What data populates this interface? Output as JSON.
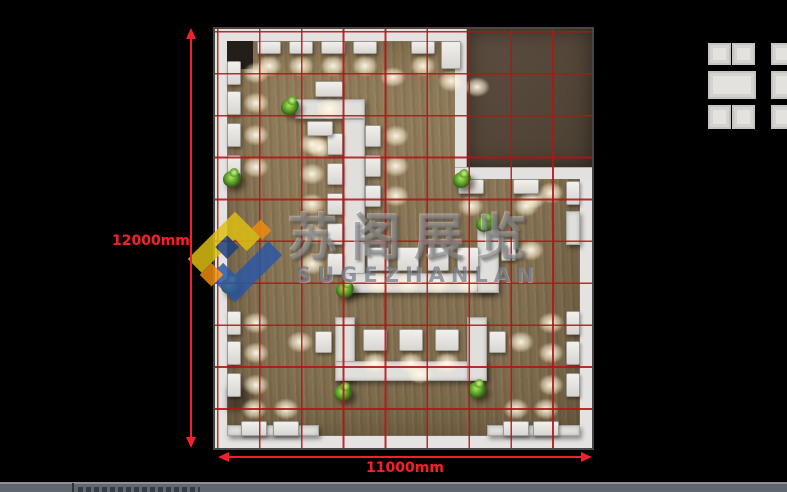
{
  "scene": {
    "description": "Top-down 3D rendered exhibition hall floor plan with red measurement grid on black background"
  },
  "dimensions": {
    "vertical_label": "12000mm",
    "horizontal_label": "11000mm",
    "color": "#f1202a"
  },
  "watermark": {
    "cn_text": "苏阁展览",
    "latin_text": "SUGEZHANLAN",
    "logo_colors": {
      "yellow": "#dec013",
      "blue": "#2b57a5",
      "orange": "#ef8c0e",
      "navy": "#1d3e7a"
    }
  },
  "floorplan": {
    "grid_color": "#b31414",
    "floor_color": "#8e7a5a",
    "wall_color": "#e4e3e1",
    "meeting_room_floor_color": "#54473a",
    "plant_color": "#569426"
  },
  "statusbar": {
    "bar_color": "#63686e"
  }
}
